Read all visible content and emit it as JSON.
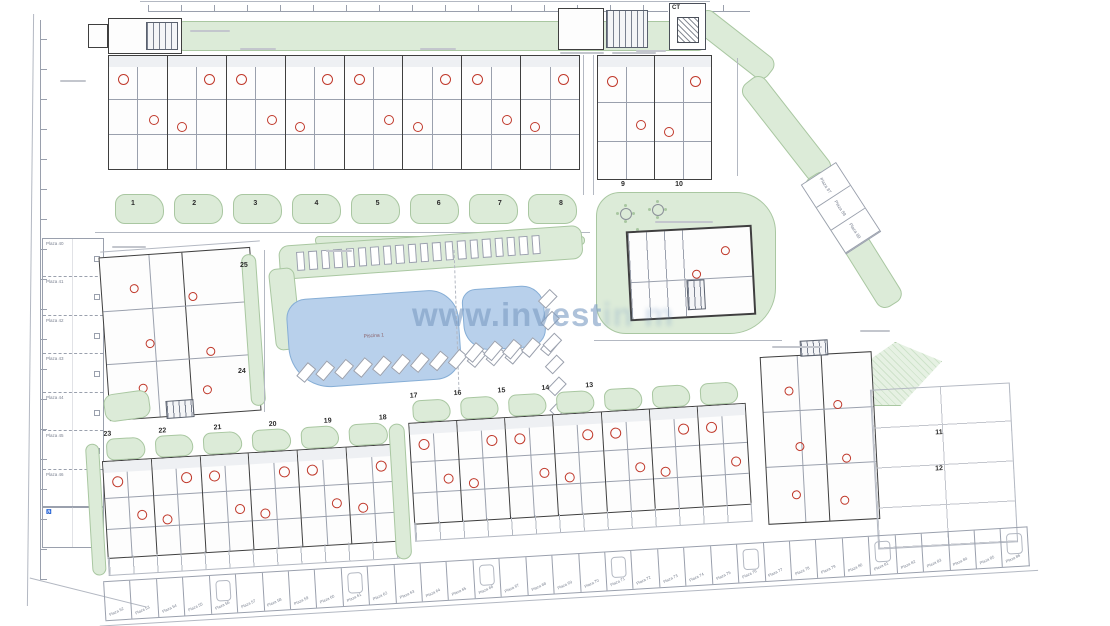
{
  "watermark": {
    "text": "www.invest",
    "tail": "in m",
    "color": "#7d9cc3"
  },
  "labels": {
    "ct": "CT",
    "pool_large_name": "Piscina 1",
    "accessible_icon": "♿"
  },
  "blocks": {
    "top_a_units": [
      "1",
      "2",
      "3",
      "4",
      "5",
      "6",
      "7",
      "8"
    ],
    "top_b_units": [
      "9",
      "10"
    ],
    "mid_left_upper": "25",
    "mid_left_lower": "24",
    "right_plot_upper": "11",
    "right_plot_lower": "12",
    "bottom_left_units": [
      "23",
      "22",
      "21",
      "20",
      "19",
      "18"
    ],
    "bottom_center_units": [
      "17",
      "16",
      "15",
      "14",
      "13"
    ]
  },
  "parking": {
    "left_column": [
      "Plaza 40",
      "Plaza 41",
      "Plaza 42",
      "Plaza 43",
      "Plaza 44",
      "Plaza 45",
      "Plaza 46"
    ],
    "bottom_row": [
      "Plaza 52",
      "Plaza 53",
      "Plaza 54",
      "Plaza 55",
      "Plaza 56",
      "Plaza 57",
      "Plaza 58",
      "Plaza 59",
      "Plaza 60",
      "Plaza 61",
      "Plaza 62",
      "Plaza 63",
      "Plaza 64",
      "Plaza 65",
      "Plaza 66",
      "Plaza 67",
      "Plaza 68",
      "Plaza 69",
      "Plaza 70",
      "Plaza 71",
      "Plaza 72",
      "Plaza 73",
      "Plaza 74",
      "Plaza 75",
      "Plaza 76",
      "Plaza 77",
      "Plaza 78",
      "Plaza 79",
      "Plaza 80",
      "Plaza 81",
      "Plaza 82",
      "Plaza 83",
      "Plaza 84",
      "Plaza 85",
      "Plaza 86"
    ],
    "right_diagonal": [
      "Plaza 87",
      "Plaza 88",
      "Plaza 89"
    ]
  },
  "decor": {
    "sunbeds_top": 20,
    "sunbeds_bottom_large": 12,
    "sunbeds_bottom_small": 5,
    "sunbeds_right": 6,
    "garden_blobs_top": 8,
    "garden_blobs_bottom_left": 6,
    "garden_blobs_bottom_center": 7,
    "cells_bottom_center": 7,
    "tables": 3
  },
  "colors": {
    "green": "#dcebd8",
    "green_border": "#a9c7a1",
    "pool": "#b8d0eb",
    "pool_border": "#86aed6",
    "red_accent": "#c0392b",
    "wall": "#3f3f3f",
    "light_line": "#b3b8c2"
  }
}
